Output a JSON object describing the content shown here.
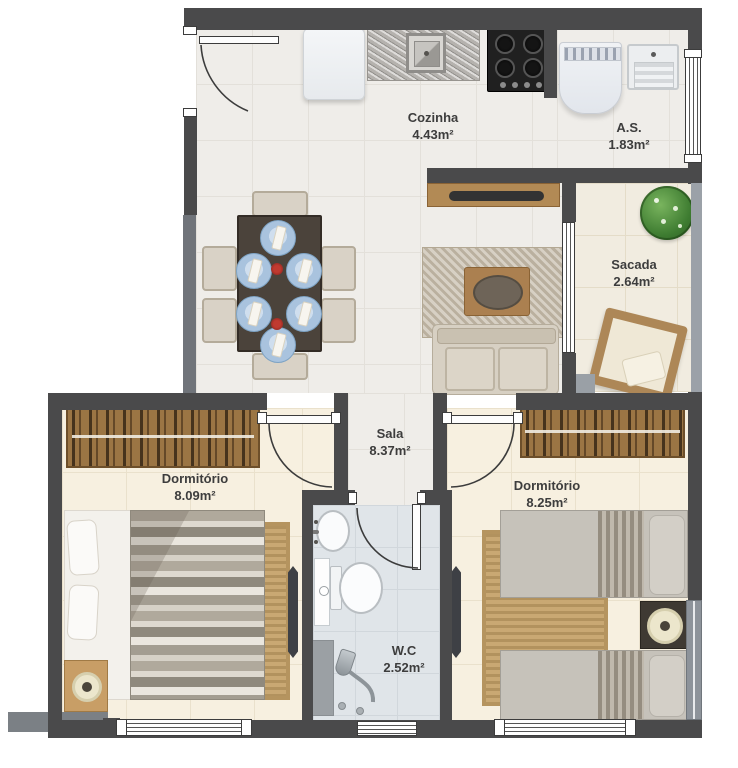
{
  "title": "Apartment floor plan",
  "rooms": {
    "cozinha": {
      "name": "Cozinha",
      "area": "4.43m²"
    },
    "as": {
      "name": "A.S.",
      "area": "1.83m²"
    },
    "sacada": {
      "name": "Sacada",
      "area": "2.64m²"
    },
    "sala": {
      "name": "Sala",
      "area": "8.37m²"
    },
    "dormitorio_1": {
      "name": "Dormitório",
      "area": "8.09m²"
    },
    "dormitorio_2": {
      "name": "Dormitório",
      "area": "8.25m²"
    },
    "wc": {
      "name": "W.C",
      "area": "2.52m²"
    }
  },
  "colors": {
    "wall_dark": "#4a4a4b",
    "wall_light": "#70747a",
    "floor_living": "#efede9",
    "floor_bedroom": "#f7f0e0",
    "floor_wc": "#e0e5e9",
    "floor_balcony": "#f1ece0",
    "wood": "#9b7544",
    "plant_green": "#3e7c31",
    "label_text": "#3d3d3d"
  }
}
